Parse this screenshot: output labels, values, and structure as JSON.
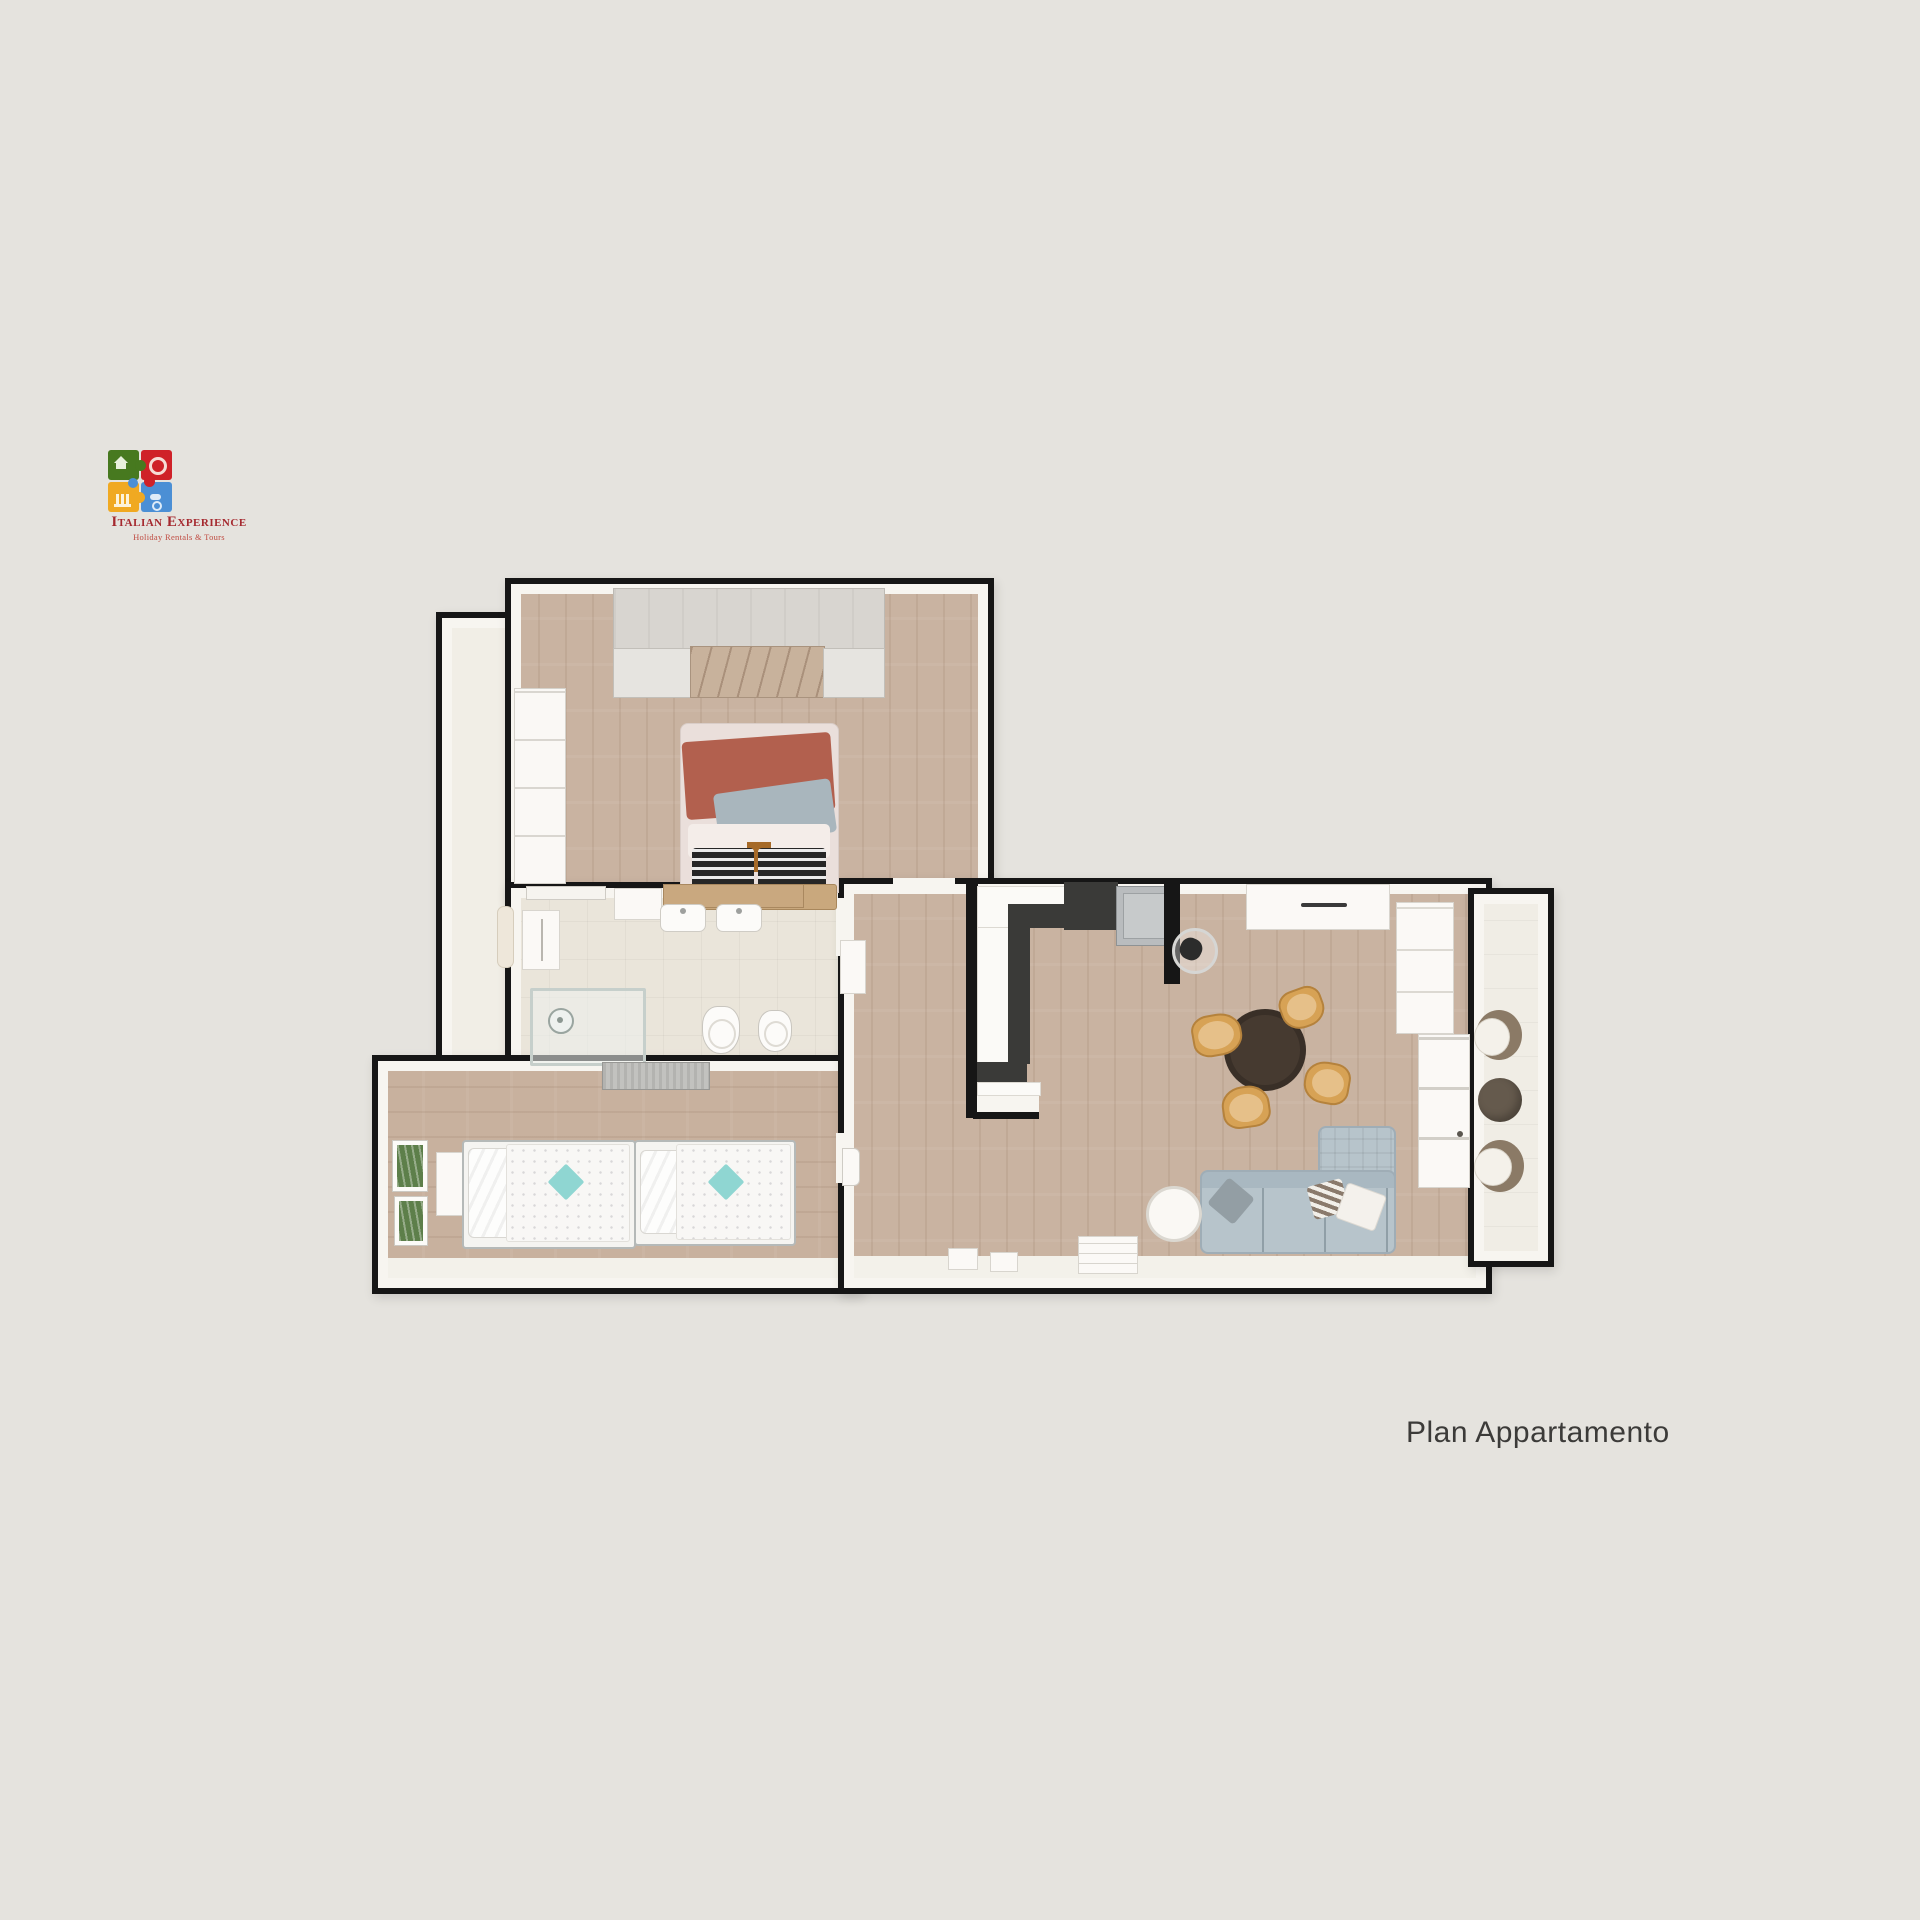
{
  "page": {
    "background_color": "#e5e3de"
  },
  "logo": {
    "title": "Italian Experience",
    "subtitle": "Holiday Rentals & Tours",
    "title_color": "#a5292f",
    "piece_colors": {
      "green": "#47791f",
      "red": "#cf2128",
      "yellow": "#f0a922",
      "blue": "#4b8fd5"
    }
  },
  "caption": {
    "text": "Plan Appartamento",
    "color": "#3c3b39"
  },
  "plan": {
    "colors": {
      "wall": "#161616",
      "wall_face": "#f7f5f0",
      "wood_floor": "#c9b3a1",
      "bath_tile": "#eae5da",
      "balcony_tile": "#f0ede5",
      "terracotta_blanket": "#b2604e",
      "gray_blanket": "#a9b6bd",
      "sofa": "#b7c4cb",
      "dining_table": "#463a30",
      "chair_wood": "#d7a255",
      "teal_cushion": "#8fd6d2",
      "kitchen_counter_dark": "#3a3a38",
      "appliance_gray": "#b9bcbe",
      "balcony_chair_brown": "#8b7a66",
      "headboard_wood": "#c9a87d"
    }
  }
}
